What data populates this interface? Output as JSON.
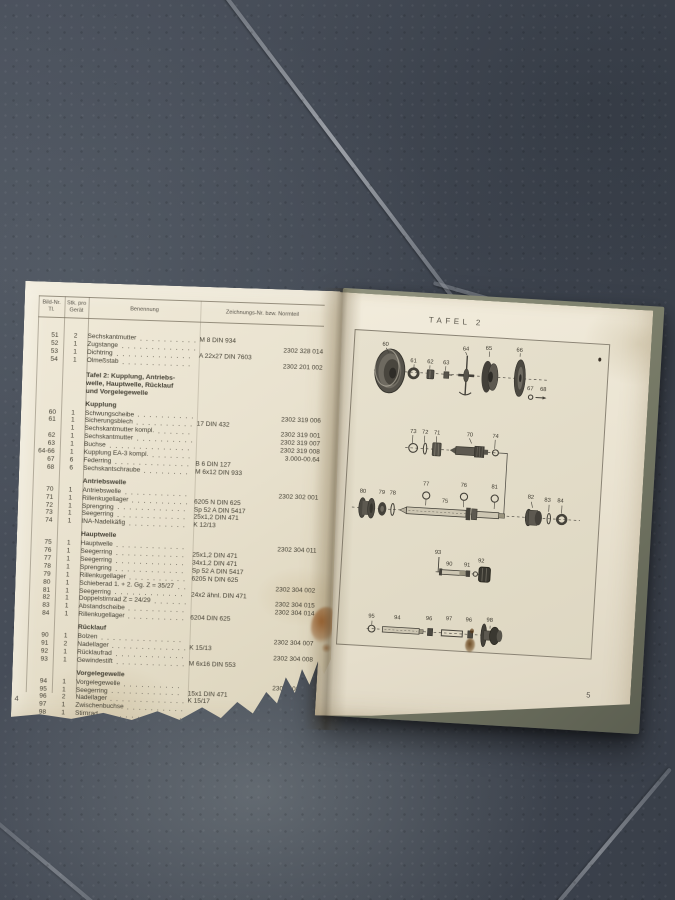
{
  "page_numbers": {
    "left": "4",
    "right": "5"
  },
  "colors": {
    "paper": "#e9e2cf",
    "floor_tile": "#424955",
    "grout": "#9aa0a7",
    "book_cover": "#7a7d6a",
    "diagram_ink": "#45423a",
    "rust_stain": "#96541e"
  },
  "table": {
    "headers": {
      "col_no_line1": "Bild-Nr.",
      "col_no_line2": "Tl.",
      "col_qty_line1": "Stk. pro",
      "col_qty_line2": "Gerät",
      "col_name": "Benennung",
      "col_drawing": "Zeichnungs-Nr. bzw. Normteil"
    },
    "sections": [
      {
        "rows": [
          {
            "no": "51",
            "qty": "2",
            "name": "Sechskantmutter",
            "norm": "M 8 DIN 934",
            "part": ""
          },
          {
            "no": "52",
            "qty": "1",
            "name": "Zugstange",
            "norm": "",
            "part": "2302 328 014"
          },
          {
            "no": "53",
            "qty": "1",
            "name": "Dichtring",
            "norm": "A 22x27 DIN 7603",
            "part": ""
          },
          {
            "no": "54",
            "qty": "1",
            "name": "Ölmeßstab",
            "norm": "",
            "part": "2302 201 002"
          }
        ]
      },
      {
        "heading_lines": [
          "Tafel 2: Kupplung, Antriebs-",
          "welle, Hauptwelle, Rücklauf",
          "und Vorgelegewelle"
        ],
        "rows": []
      },
      {
        "title": "Kupplung",
        "rows": [
          {
            "no": "60",
            "qty": "1",
            "name": "Schwungscheibe",
            "norm": "",
            "part": "2302 319 006"
          },
          {
            "no": "61",
            "qty": "1",
            "name": "Sicherungsblech",
            "norm": "17 DIN 432",
            "part": ""
          },
          {
            "no": "",
            "qty": "1",
            "name": "Sechskantmutter kompl.",
            "norm": "",
            "part": "2302 319 001"
          },
          {
            "no": "62",
            "qty": "1",
            "name": "Sechskantmutter",
            "norm": "",
            "part": "2302 319 007"
          },
          {
            "no": "63",
            "qty": "1",
            "name": "Buchse",
            "norm": "",
            "part": "2302 319 008"
          },
          {
            "no": "64-66",
            "qty": "1",
            "name": "Kupplung EA-3 kompl.",
            "norm": "",
            "part": "3.000-00.64"
          },
          {
            "no": "67",
            "qty": "6",
            "name": "Federring",
            "norm": "B 6 DIN 127",
            "part": ""
          },
          {
            "no": "68",
            "qty": "6",
            "name": "Sechskantschraube",
            "norm": "M 6x12 DIN 933",
            "part": ""
          }
        ]
      },
      {
        "title": "Antriebswelle",
        "rows": [
          {
            "no": "70",
            "qty": "1",
            "name": "Antriebswelle",
            "norm": "",
            "part": "2302 302 001"
          },
          {
            "no": "71",
            "qty": "1",
            "name": "Rillenkugellager",
            "norm": "6205 N DIN 625",
            "part": ""
          },
          {
            "no": "72",
            "qty": "1",
            "name": "Sprengring",
            "norm": "Sp 52 A DIN 5417",
            "part": ""
          },
          {
            "no": "73",
            "qty": "1",
            "name": "Seegerring",
            "norm": "25x1,2 DIN 471",
            "part": ""
          },
          {
            "no": "74",
            "qty": "1",
            "name": "INA-Nadelkäfig",
            "norm": "K 12/13",
            "part": ""
          }
        ]
      },
      {
        "title": "Hauptwelle",
        "rows": [
          {
            "no": "75",
            "qty": "1",
            "name": "Hauptwelle",
            "norm": "",
            "part": "2302 304 011"
          },
          {
            "no": "76",
            "qty": "1",
            "name": "Seegerring",
            "norm": "25x1,2 DIN 471",
            "part": ""
          },
          {
            "no": "77",
            "qty": "1",
            "name": "Seegerring",
            "norm": "34x1,2 DIN 471",
            "part": ""
          },
          {
            "no": "78",
            "qty": "1",
            "name": "Sprengring",
            "norm": "Sp 52 A DIN 5417",
            "part": ""
          },
          {
            "no": "79",
            "qty": "1",
            "name": "Rillenkugellager",
            "norm": "6205 N DIN 625",
            "part": ""
          },
          {
            "no": "80",
            "qty": "1",
            "name": "Schieberad 1. + 2. Gg.  Z = 35/27",
            "norm": "",
            "part": "2302 304 002"
          },
          {
            "no": "81",
            "qty": "1",
            "name": "Seegerring",
            "norm": "24x2 ähnl. DIN 471",
            "part": ""
          },
          {
            "no": "82",
            "qty": "1",
            "name": "Doppelstirnrad  Z = 24/29",
            "norm": "",
            "part": "2302 304 015"
          },
          {
            "no": "83",
            "qty": "1",
            "name": "Abstandscheibe",
            "norm": "",
            "part": "2302 304 014"
          },
          {
            "no": "84",
            "qty": "1",
            "name": "Rillenkugellager",
            "norm": "6204 DIN 625",
            "part": ""
          }
        ]
      },
      {
        "title": "Rücklauf",
        "rows": [
          {
            "no": "90",
            "qty": "1",
            "name": "Bolzen",
            "norm": "",
            "part": "2302 304 007"
          },
          {
            "no": "91",
            "qty": "2",
            "name": "Nadellager",
            "norm": "K 15/13",
            "part": ""
          },
          {
            "no": "92",
            "qty": "1",
            "name": "Rücklaufrad",
            "norm": "",
            "part": "2302 304 008"
          },
          {
            "no": "93",
            "qty": "1",
            "name": "Gewindestift",
            "norm": "M 6x16 DIN 553",
            "part": ""
          }
        ]
      },
      {
        "title": "Vorgelegewelle",
        "rows": [
          {
            "no": "94",
            "qty": "1",
            "name": "Vorgelegewelle",
            "norm": "",
            "part": "2302 303 001"
          },
          {
            "no": "95",
            "qty": "1",
            "name": "Seegerring",
            "norm": "15x1 DIN 471",
            "part": ""
          },
          {
            "no": "96",
            "qty": "2",
            "name": "Nadellager",
            "norm": "K 15/17",
            "part": ""
          },
          {
            "no": "97",
            "qty": "1",
            "name": "Zwischenbuchse",
            "norm": "",
            "part": "2302 303 002"
          },
          {
            "no": "98",
            "qty": "1",
            "name": "Stirnrad",
            "norm": "",
            "part": "2302 303 003"
          }
        ]
      }
    ]
  },
  "diagram": {
    "title": "TAFEL 2",
    "labels": [
      {
        "text": "60",
        "x": 27,
        "y": 14
      },
      {
        "text": "61",
        "x": 56,
        "y": 29
      },
      {
        "text": "62",
        "x": 73,
        "y": 29
      },
      {
        "text": "63",
        "x": 89,
        "y": 29
      },
      {
        "text": "64",
        "x": 108,
        "y": 14
      },
      {
        "text": "65",
        "x": 131,
        "y": 12
      },
      {
        "text": "66",
        "x": 162,
        "y": 12
      },
      {
        "text": "67",
        "x": 175,
        "y": 50
      },
      {
        "text": "68",
        "x": 188,
        "y": 50
      },
      {
        "text": "73",
        "x": 60,
        "y": 100
      },
      {
        "text": "72",
        "x": 72,
        "y": 100
      },
      {
        "text": "71",
        "x": 84,
        "y": 100
      },
      {
        "text": "70",
        "x": 117,
        "y": 100
      },
      {
        "text": "74",
        "x": 143,
        "y": 100
      },
      {
        "text": "80",
        "x": 13,
        "y": 163
      },
      {
        "text": "79",
        "x": 32,
        "y": 163
      },
      {
        "text": "78",
        "x": 43,
        "y": 163
      },
      {
        "text": "77",
        "x": 76,
        "y": 152
      },
      {
        "text": "75",
        "x": 96,
        "y": 168
      },
      {
        "text": "76",
        "x": 114,
        "y": 151
      },
      {
        "text": "81",
        "x": 145,
        "y": 151
      },
      {
        "text": "82",
        "x": 182,
        "y": 159
      },
      {
        "text": "83",
        "x": 199,
        "y": 161
      },
      {
        "text": "84",
        "x": 212,
        "y": 161
      },
      {
        "text": "93",
        "x": 92,
        "y": 220
      },
      {
        "text": "90",
        "x": 104,
        "y": 231
      },
      {
        "text": "91",
        "x": 122,
        "y": 231
      },
      {
        "text": "92",
        "x": 136,
        "y": 226
      },
      {
        "text": "95",
        "x": 29,
        "y": 288
      },
      {
        "text": "94",
        "x": 55,
        "y": 288
      },
      {
        "text": "96",
        "x": 87,
        "y": 287
      },
      {
        "text": "97",
        "x": 107,
        "y": 286
      },
      {
        "text": "96",
        "x": 127,
        "y": 286
      },
      {
        "text": "98",
        "x": 148,
        "y": 285
      }
    ]
  }
}
